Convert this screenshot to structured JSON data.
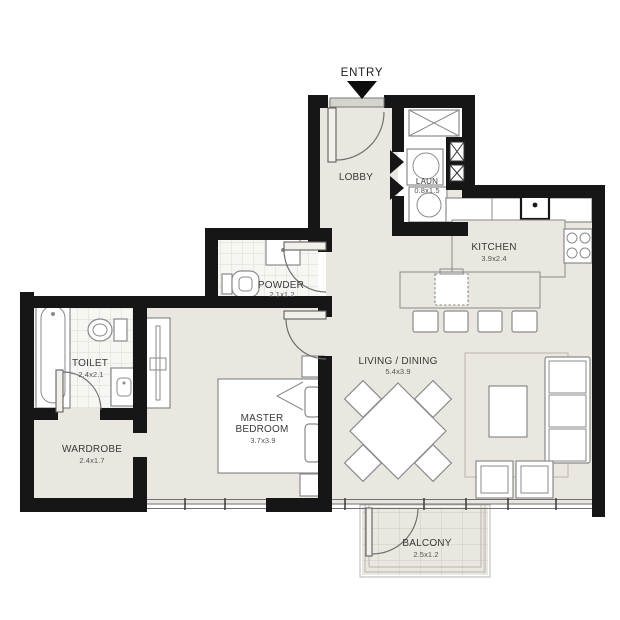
{
  "entry": {
    "label": "ENTRY"
  },
  "rooms": {
    "lobby": {
      "name": "LOBBY"
    },
    "laundry": {
      "name": "LAUN",
      "dims": "0.8x1.5"
    },
    "kitchen": {
      "name": "KITCHEN",
      "dims": "3.9x2.4"
    },
    "powder": {
      "name": "POWDER",
      "dims": "2.1x1.2"
    },
    "toilet": {
      "name": "TOILET",
      "dims": "2.4x2.1"
    },
    "wardrobe": {
      "name": "WARDROBE",
      "dims": "2.4x1.7"
    },
    "master_bedroom": {
      "name_line1": "MASTER",
      "name_line2": "BEDROOM",
      "dims": "3.7x3.9"
    },
    "living_dining": {
      "name": "LIVING / DINING",
      "dims": "5.4x3.9"
    },
    "balcony": {
      "name": "BALCONY",
      "dims": "2.5x1.2"
    }
  },
  "colors": {
    "wall": "#161616",
    "floor": "#eae7e0",
    "tile": "#f6f6f3",
    "line": "#8a8a8a",
    "text": "#3a3a3a"
  }
}
